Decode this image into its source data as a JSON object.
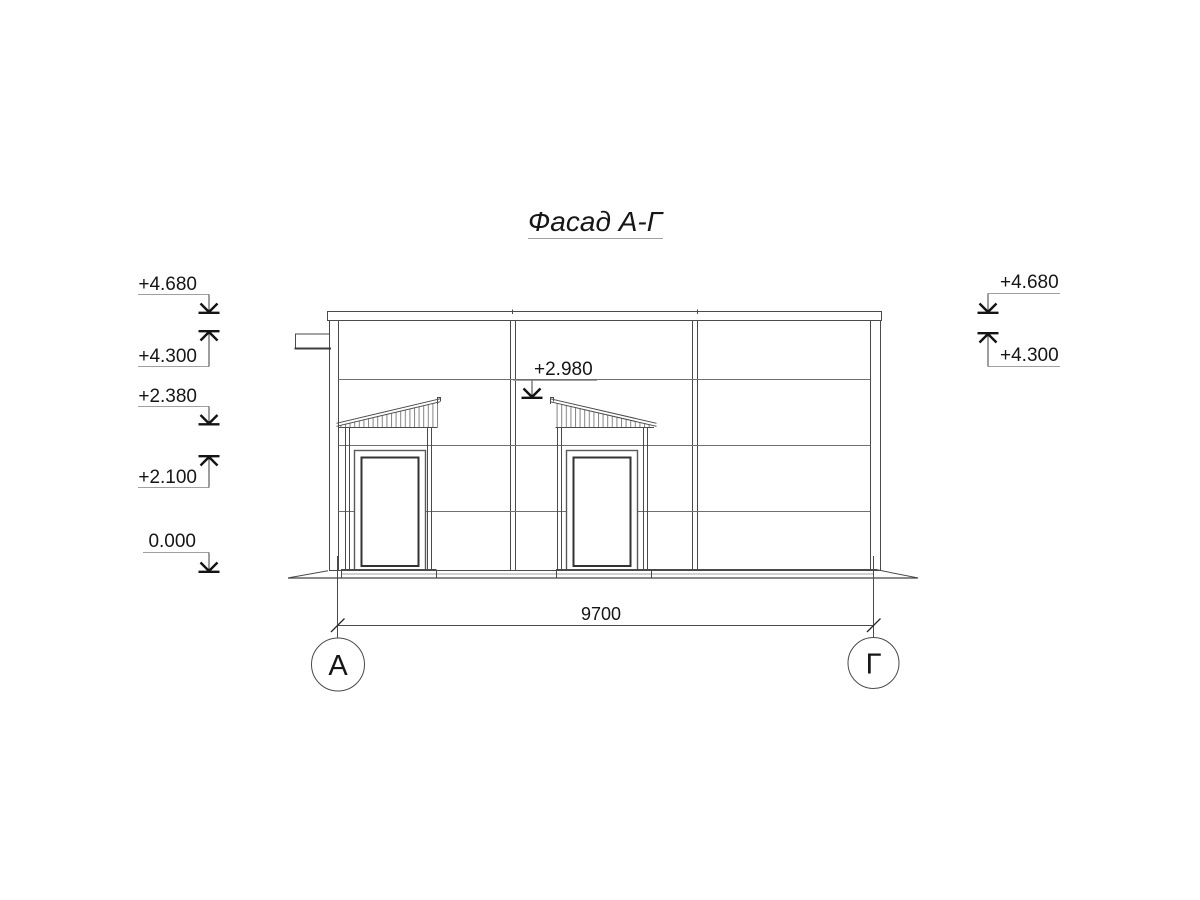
{
  "title": "Фасад А-Г",
  "marks": {
    "left": [
      {
        "label": "+4.680",
        "direction": "down"
      },
      {
        "label": "+4.300",
        "direction": "up"
      },
      {
        "label": "+2.380",
        "direction": "down"
      },
      {
        "label": "+2.100",
        "direction": "up"
      },
      {
        "label": "0.000",
        "direction": "down"
      }
    ],
    "right": [
      {
        "label": "+4.680",
        "direction": "down"
      },
      {
        "label": "+4.300",
        "direction": "up"
      }
    ],
    "canopy": {
      "label": "+2.980",
      "direction": "down"
    }
  },
  "dimension": {
    "value": "9700"
  },
  "axes": {
    "left": "А",
    "right": "Г"
  },
  "colors": {
    "background": "#ffffff",
    "line": "#4a4a4a",
    "joint_line": "#707070",
    "annotation": "#141414",
    "leader": "#a0a0a0"
  }
}
